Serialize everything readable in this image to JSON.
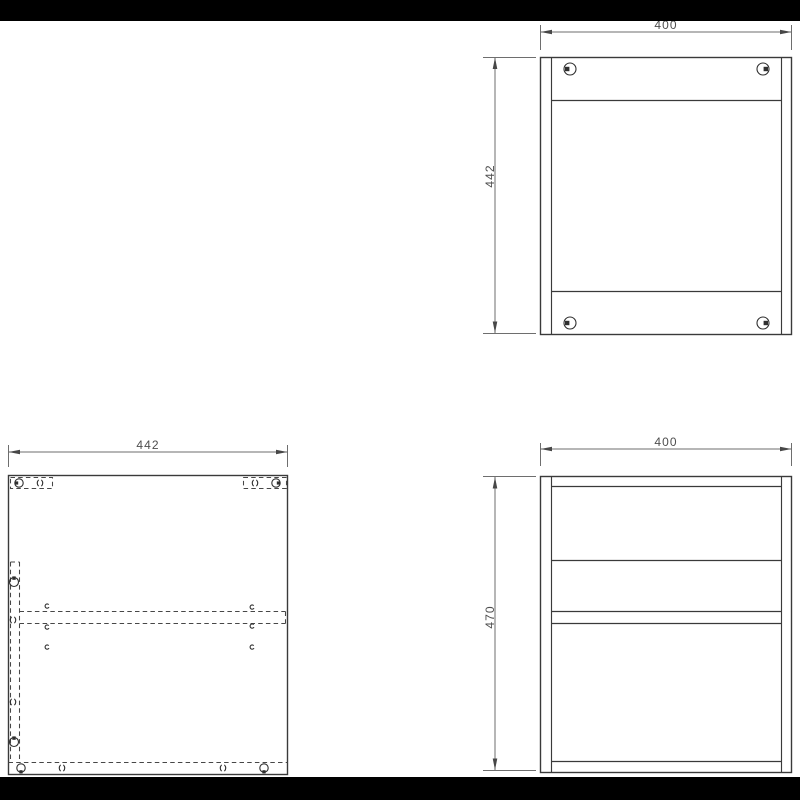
{
  "viewer": {
    "letterbox_color": "#000000",
    "canvas_color": "#ffffff"
  },
  "drawing": {
    "back_panel_view": {
      "width_label": "400",
      "height_label": "442"
    },
    "side_panel_view": {
      "width_label": "442"
    },
    "front_view": {
      "width_label": "400",
      "height_label": "470"
    },
    "colors": {
      "object_line": "#3a3a3a",
      "dimension_line": "#6e6e6e",
      "hidden_line": "#474747",
      "label_text": "#4e4e4e"
    },
    "icons": {
      "fastener": "cam-lock-icon",
      "hole": "drill-hole-icon",
      "dowel": "dowel-mark-icon"
    }
  }
}
